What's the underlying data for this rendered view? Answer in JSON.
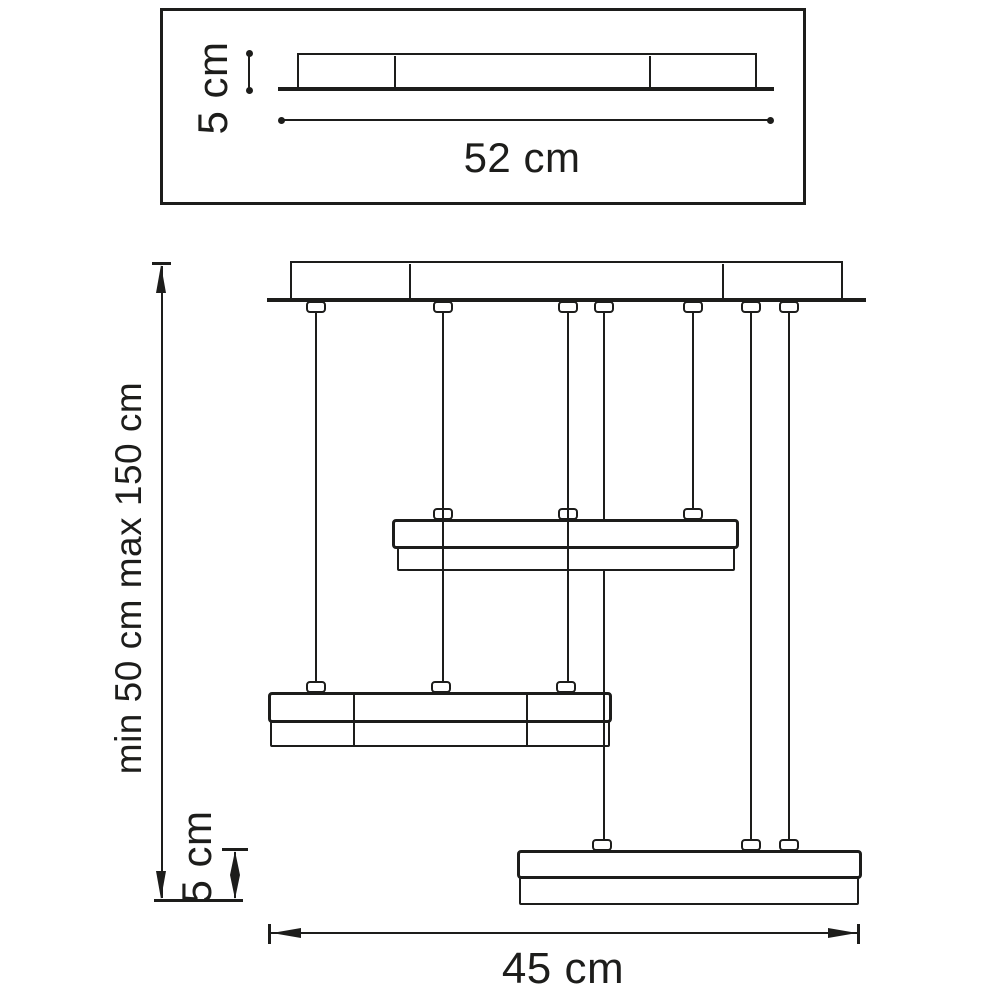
{
  "diagram": {
    "title_semantic": "pendant-lamp-dimension-drawing",
    "background_color": "#ffffff",
    "line_color": "#1d1d1b",
    "top_view": {
      "height_label": "5 cm",
      "width_label": "52 cm"
    },
    "front_view": {
      "suspension_range_label": "min 50 cm max 150 cm",
      "shade_height_label": "5 cm",
      "width_label": "45 cm"
    }
  }
}
